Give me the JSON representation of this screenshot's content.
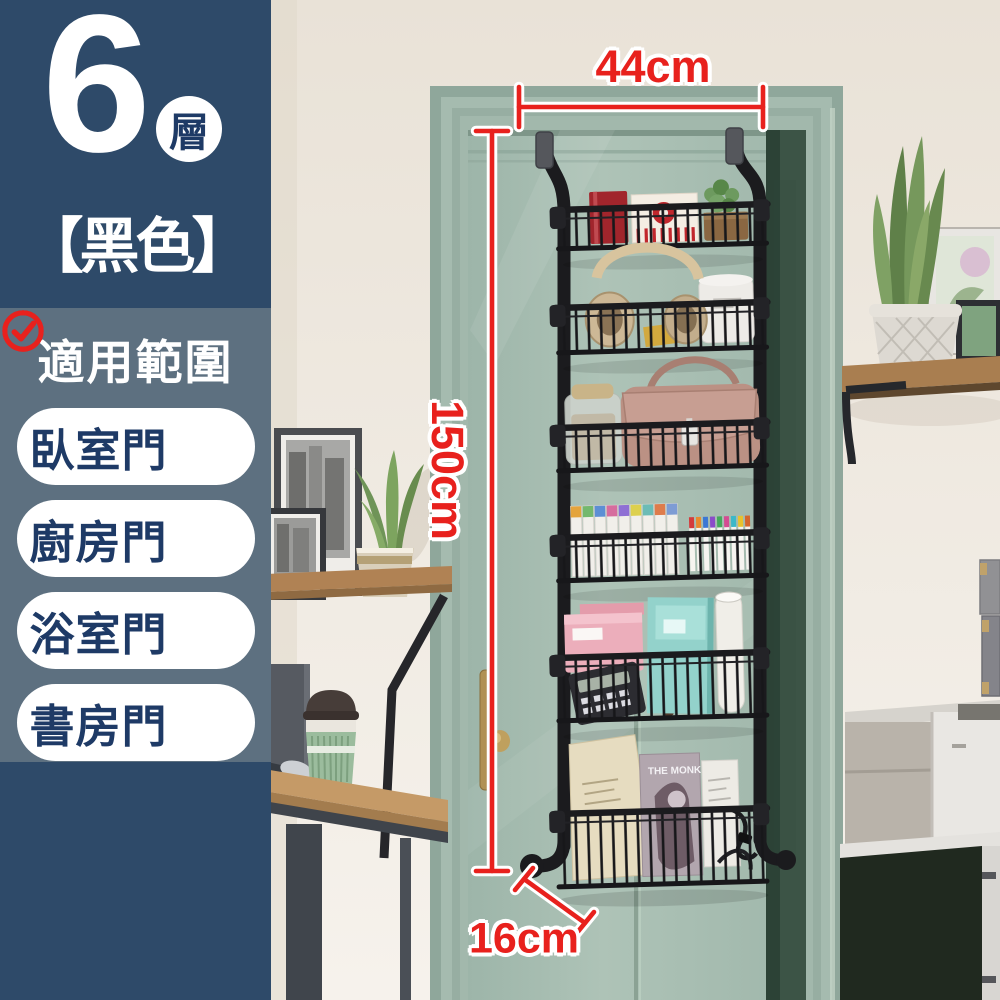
{
  "sidebar": {
    "tier_count": "6",
    "tier_unit": "層",
    "color_variant": "【黑色】",
    "scope": {
      "title": "適用範圍",
      "items": [
        {
          "label": "臥室門"
        },
        {
          "label": "廚房門"
        },
        {
          "label": "浴室門"
        },
        {
          "label": "書房門"
        }
      ]
    }
  },
  "annotations": {
    "width": "44cm",
    "height": "150cm",
    "depth": "16cm"
  },
  "scene": {
    "magazine_title": "THE MONK"
  },
  "colors": {
    "accent_red": "#e8211d",
    "sidebar_dark": "#2e4a69",
    "sidebar_light": "#5d7080",
    "pill_text": "#1e3a66",
    "door_sage": "#a9bfb3",
    "rack_black": "#1c1c1f",
    "wall_cream": "#ebe5dc",
    "wood_brown": "#b5885a"
  }
}
